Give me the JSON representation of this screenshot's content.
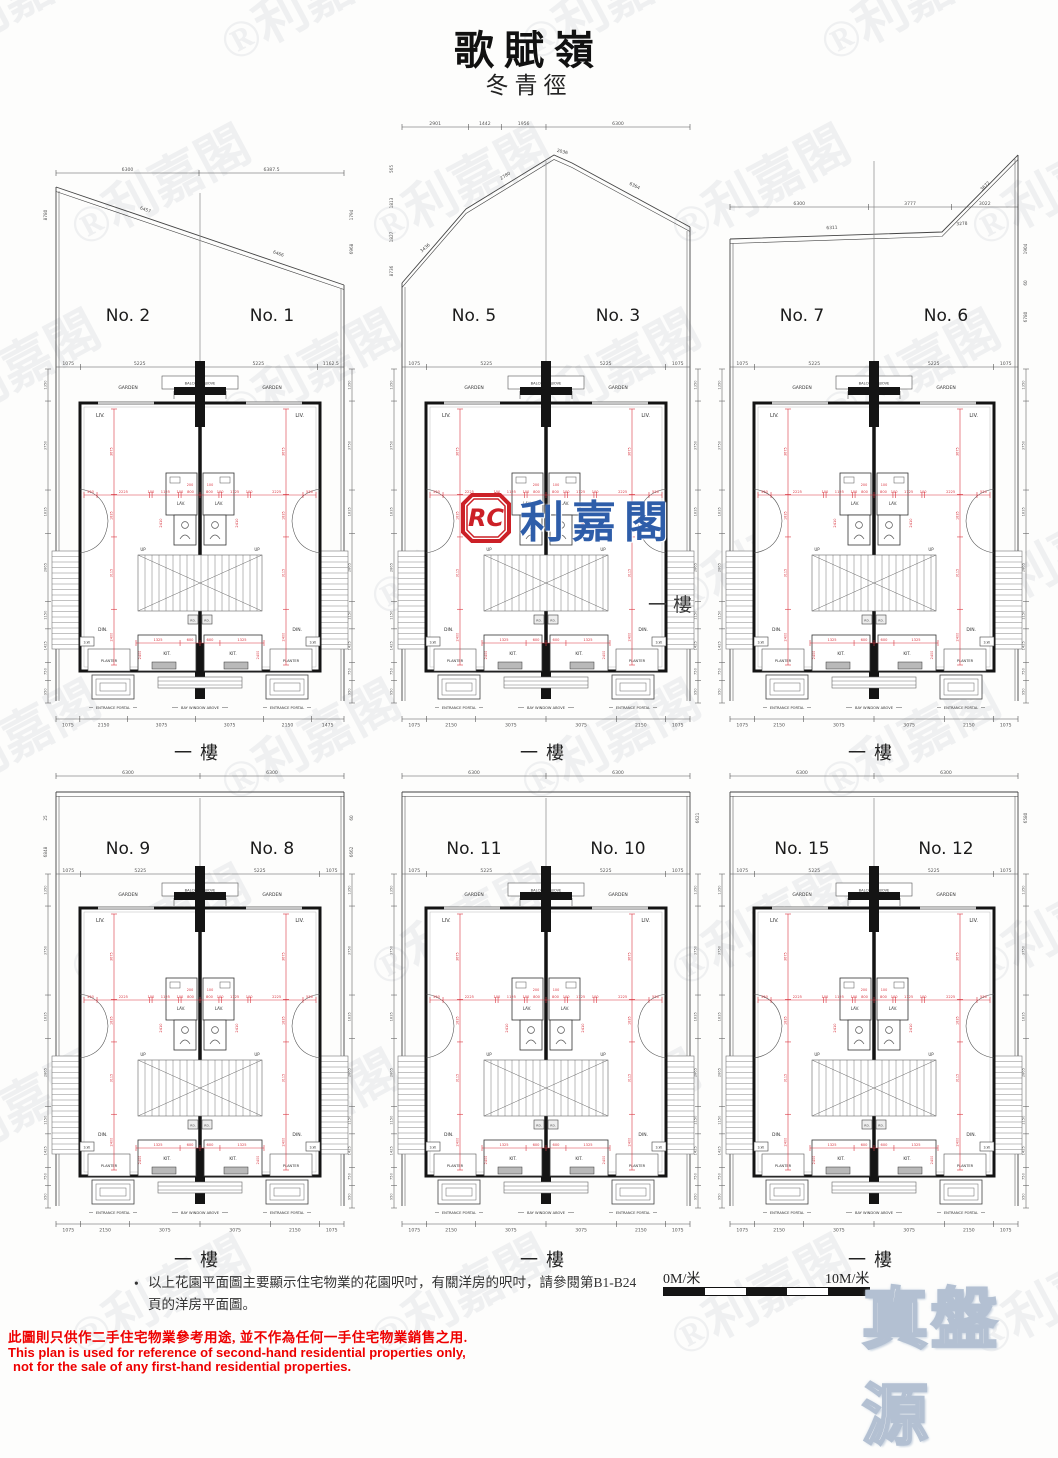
{
  "page": {
    "title": "歌賦嶺",
    "subtitle": "冬青徑"
  },
  "logo": {
    "monogram": "RC",
    "name": "利嘉閣"
  },
  "watermark_text": "利嘉閣",
  "brand_watermark": "真盤源",
  "center_floor_label": "一樓",
  "note_bullet": "•",
  "note": "以上花園平面圖主要顯示住宅物業的花園呎吋，有關洋房的呎吋，請參閱第B1-B24頁的洋房平面圖。",
  "scale_bar": {
    "start": "0M/米",
    "end": "10M/米"
  },
  "disclaimer": {
    "zh": "此圖則只供作二手住宅物業參考用途, 並不作為任何一手住宅物業銷售之用.",
    "en_line1": "This plan is used for reference of second-hand residential properties only,",
    "en_line2": "not for the sale of any first-hand residential properties."
  },
  "colors": {
    "red_dim": "#d93640",
    "wall": "#141414",
    "logo_red": "#cc2027",
    "logo_blue": "#2e5da9",
    "disclaimer_red": "#ee0000"
  },
  "unit_labels": {
    "liv": "LIV.",
    "lav": "LAV.",
    "din": "DIN.",
    "kit": "KIT.",
    "planter": "PLANTER",
    "sw": "S.W.",
    "up": "UP",
    "pd": "P.D.",
    "entrance_portal": "ENTRANCE PORTAL",
    "bay_window": "BAY WINDOW ABOVE",
    "balcony": "BALCONY ABOVE",
    "garden": "GARDEN"
  },
  "red_dims": {
    "h_main": [
      "550",
      "2225",
      "100",
      "1125",
      "100",
      "800",
      "800",
      "100",
      "1125",
      "100",
      "2225",
      "550"
    ],
    "h_center_top": [
      "200",
      "100"
    ],
    "h_kitchen": [
      "1325",
      "600",
      "600",
      "1325"
    ],
    "v_side": [
      "3675",
      "1835",
      "3115",
      "2400"
    ],
    "v_center": "2410",
    "v_kitchen": "2400"
  },
  "outer_dims": {
    "right": [
      "1350",
      "3750",
      "1835",
      "2865",
      "1150",
      "1425",
      "750",
      "950"
    ]
  },
  "plans": [
    {
      "left_no": "No. 2",
      "right_no": "No. 1",
      "shape": "slantA",
      "top_dims": [
        "6300",
        "6387.5"
      ],
      "roof_dims": [
        "6457",
        "6466"
      ],
      "side_left": [
        "8780"
      ],
      "side_right": [
        "1794",
        "6968"
      ],
      "garden_dims": [
        "1075",
        "5225",
        "5225",
        "1162.5"
      ],
      "bottom_dims": [
        "1075",
        "2150",
        "3075",
        "3075",
        "2150",
        "1475"
      ],
      "floor_label": "一樓"
    },
    {
      "left_no": "No. 5",
      "right_no": "No. 3",
      "shape": "peak",
      "top_dims": [
        "2901",
        "1442",
        "1956",
        "6300"
      ],
      "roof_dims": [
        "3436",
        "2780",
        "2036",
        "6364"
      ],
      "side_left": [
        "565",
        "1813",
        "1827",
        "8736"
      ],
      "side_right": [],
      "garden_dims": [
        "1075",
        "5225",
        "5225",
        "1075"
      ],
      "bottom_dims": [
        "1075",
        "2150",
        "3075",
        "3075",
        "2150",
        "1075"
      ],
      "floor_label": "一樓"
    },
    {
      "left_no": "No. 7",
      "right_no": "No. 6",
      "shape": "slantB",
      "top_dims": [
        "6300",
        "3777",
        "3022"
      ],
      "roof_dims": [
        "6311",
        "3278",
        "3672"
      ],
      "side_left": [],
      "side_right": [
        "1904",
        "60",
        "6780"
      ],
      "garden_dims": [
        "1075",
        "5225",
        "5225",
        "1075"
      ],
      "bottom_dims": [
        "1075",
        "2150",
        "3075",
        "3075",
        "2150",
        "1075"
      ],
      "floor_label": "一樓"
    },
    {
      "left_no": "No. 9",
      "right_no": "No. 8",
      "shape": "flat",
      "top_dims": [
        "6300",
        "6300"
      ],
      "roof_dims": [],
      "side_left": [
        "25",
        "6848"
      ],
      "side_right": [
        "60",
        "6662"
      ],
      "garden_dims": [
        "1075",
        "5225",
        "5225",
        "1075"
      ],
      "bottom_dims": [
        "1075",
        "2150",
        "3075",
        "3075",
        "2150",
        "1075"
      ],
      "floor_label": "一樓"
    },
    {
      "left_no": "No. 11",
      "right_no": "No. 10",
      "shape": "flat",
      "top_dims": [
        "6300",
        "6300"
      ],
      "roof_dims": [],
      "side_left": [],
      "side_right": [
        "6621"
      ],
      "garden_dims": [
        "1075",
        "5225",
        "5225",
        "1075"
      ],
      "bottom_dims": [
        "1075",
        "2150",
        "3075",
        "3075",
        "2150",
        "1075"
      ],
      "floor_label": "一樓"
    },
    {
      "left_no": "No. 15",
      "right_no": "No. 12",
      "shape": "flat",
      "top_dims": [
        "6300",
        "6300"
      ],
      "roof_dims": [],
      "side_left": [],
      "side_right": [
        "6580"
      ],
      "garden_dims": [
        "1075",
        "5225",
        "5225",
        "1075"
      ],
      "bottom_dims": [
        "1075",
        "2150",
        "3075",
        "3075",
        "2150",
        "1075"
      ],
      "floor_label": "一樓"
    }
  ]
}
